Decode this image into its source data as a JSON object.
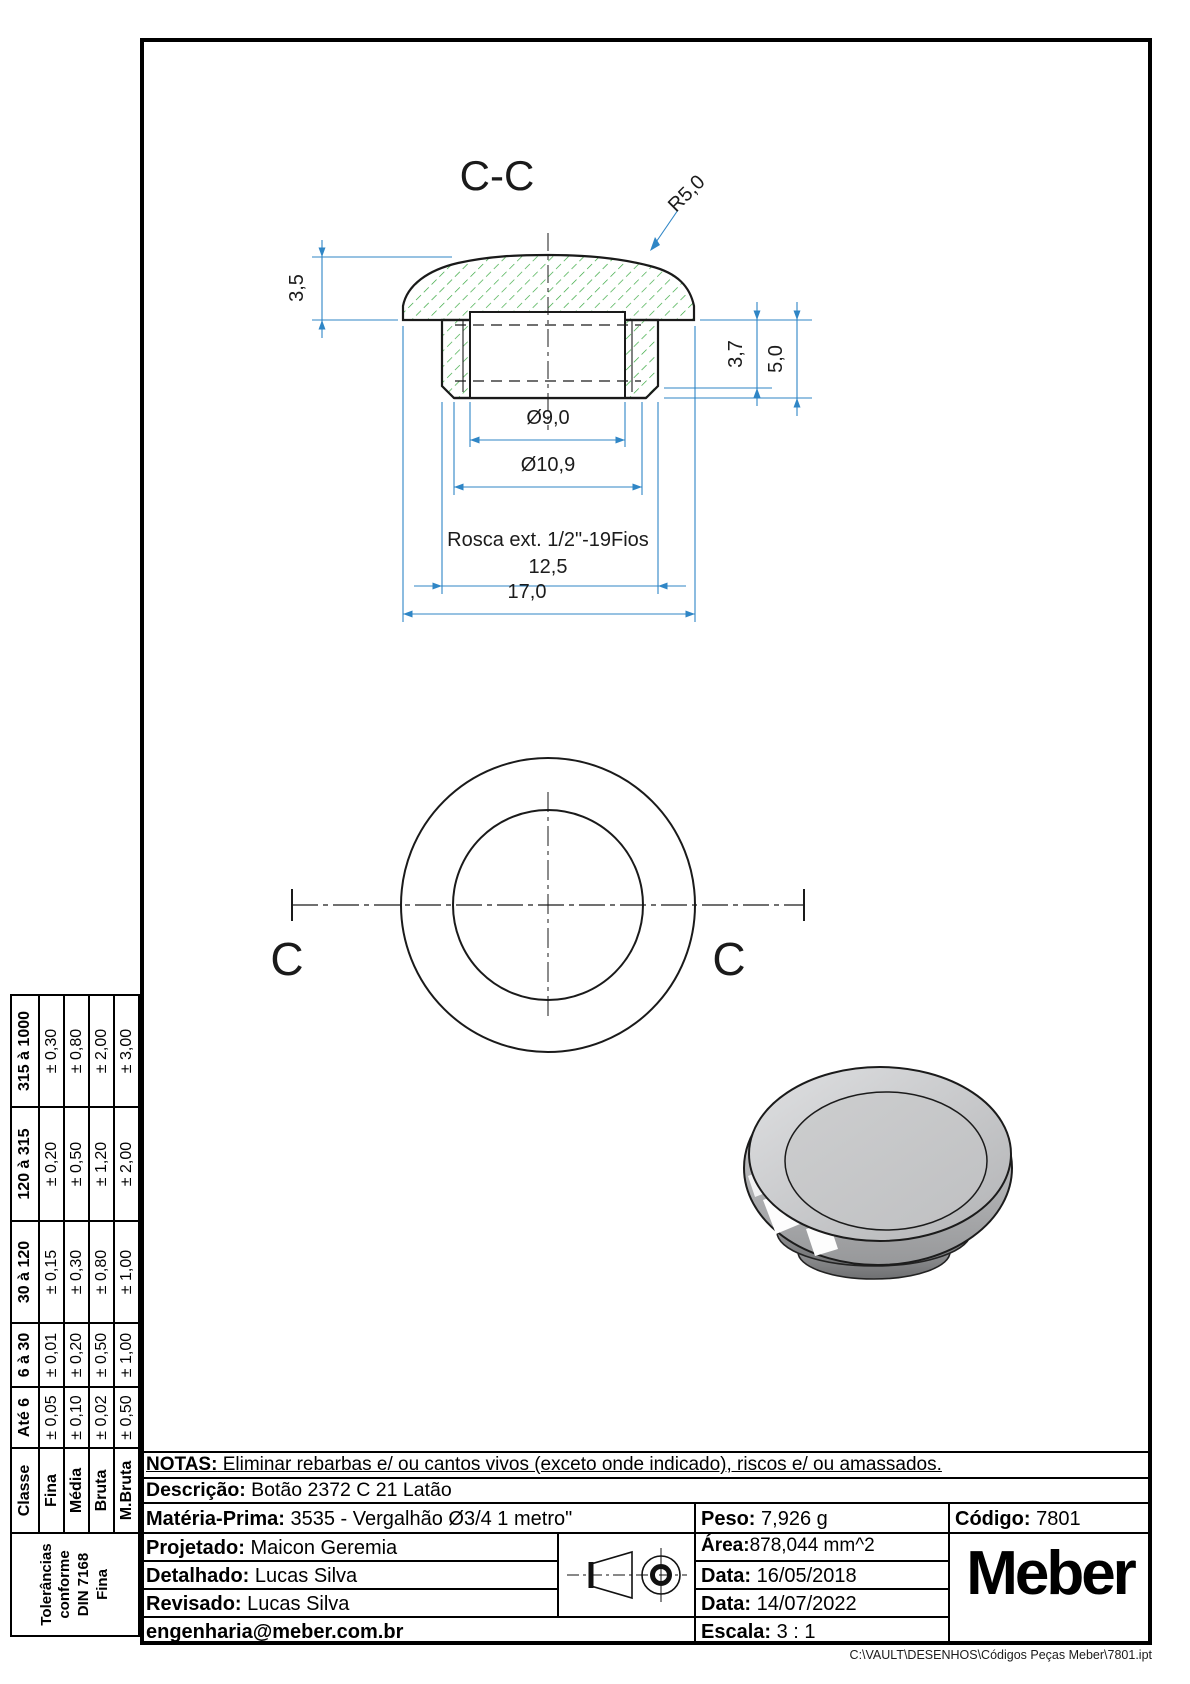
{
  "drawing": {
    "section_label": "C-C",
    "cut_left": "C",
    "cut_right": "C",
    "dims": {
      "h35": "3,5",
      "r50": "R5,0",
      "h37": "3,7",
      "h50": "5,0",
      "d90": "Ø9,0",
      "d109": "Ø10,9",
      "rosca": "Rosca ext. 1/2\"-19Fios",
      "l125": "12,5",
      "l170": "17,0"
    },
    "colors": {
      "dimension": "#2f86c6",
      "hatch": "#2fa437",
      "outline": "#1a1a1a"
    }
  },
  "tolerance_table": {
    "header": [
      "Classe",
      "Até 6",
      "6 à 30",
      "30 à 120",
      "120 à 315",
      "315 à 1000"
    ],
    "rows": [
      {
        "classe": "Fina",
        "values": [
          "± 0,05",
          "± 0,01",
          "± 0,15",
          "± 0,20",
          "± 0,30"
        ]
      },
      {
        "classe": "Média",
        "values": [
          "± 0,10",
          "± 0,20",
          "± 0,30",
          "± 0,50",
          "± 0,80"
        ]
      },
      {
        "classe": "Bruta",
        "values": [
          "± 0,02",
          "± 0,50",
          "± 0,80",
          "± 1,20",
          "± 2,00"
        ]
      },
      {
        "classe": "M.Bruta",
        "values": [
          "± 0,50",
          "± 1,00",
          "± 1,00",
          "± 2,00",
          "± 3,00"
        ]
      }
    ],
    "footer_lines": [
      "Tolerâncias",
      "conforme",
      "DIN 7168",
      "Fina"
    ]
  },
  "title_block": {
    "notas_label": "NOTAS:",
    "notas_text": " Eliminar rebarbas e/ ou cantos vivos (exceto onde indicado), riscos e/ ou amassados.",
    "descricao_label": "Descrição:",
    "descricao": " Botão 2372 C 21 Latão",
    "materia_label": "Matéria-Prima:",
    "materia": " 3535 - Vergalhão Ø3/4 1 metro\"",
    "peso_label": "Peso:",
    "peso": " 7,926 g",
    "codigo_label": "Código:",
    "codigo": " 7801",
    "projetado_label": "Projetado:",
    "projetado": " Maicon Geremia",
    "detalhado_label": "Detalhado:",
    "detalhado": " Lucas Silva",
    "revisado_label": "Revisado:",
    "revisado": " Lucas Silva",
    "email": "engenharia@meber.com.br",
    "area_label": "Área:",
    "area": "878,044 mm^2",
    "data1_label": "Data:",
    "data1": " 16/05/2018",
    "data2_label": "Data:",
    "data2": " 14/07/2022",
    "escala_label": "Escala:",
    "escala": " 3 : 1",
    "logo": "Meber"
  },
  "footer_path": "C:\\VAULT\\DESENHOS\\Códigos Peças Meber\\7801.ipt"
}
